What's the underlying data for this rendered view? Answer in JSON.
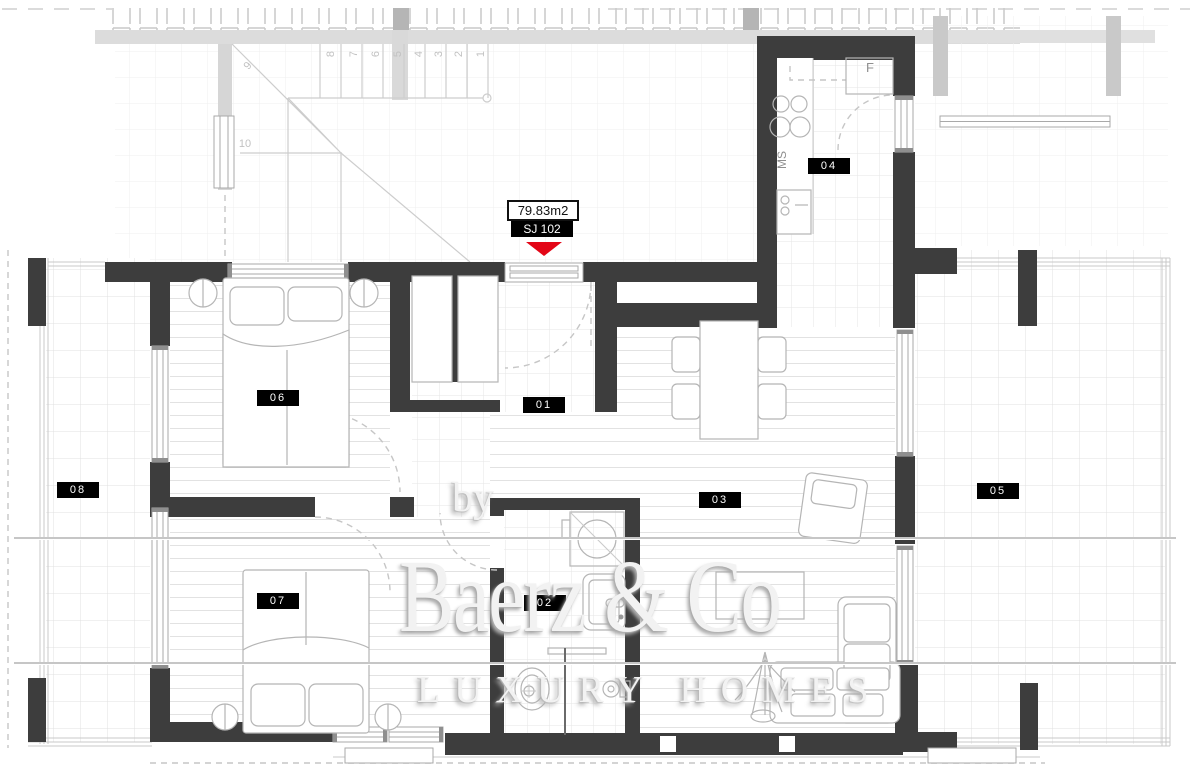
{
  "unit": {
    "area": "79.83m2",
    "code": "SJ 102"
  },
  "rooms": [
    "01",
    "02",
    "03",
    "04",
    "05",
    "06",
    "07",
    "08"
  ],
  "kitchen": {
    "fridge_label": "F",
    "counter_label": "MS"
  },
  "stairs": [
    "1",
    "2",
    "3",
    "4",
    "5",
    "6",
    "7",
    "8",
    "9",
    "10"
  ],
  "watermark": {
    "prefix": "by",
    "brand": "Baerz & Co",
    "tagline": "LUXURY HOMES"
  },
  "colors": {
    "wall": "#3d3d3d",
    "label_bg": "#000000",
    "label_text": "#ffffff",
    "marker": "#e30617",
    "watermark_text": "#f2f2f2"
  }
}
